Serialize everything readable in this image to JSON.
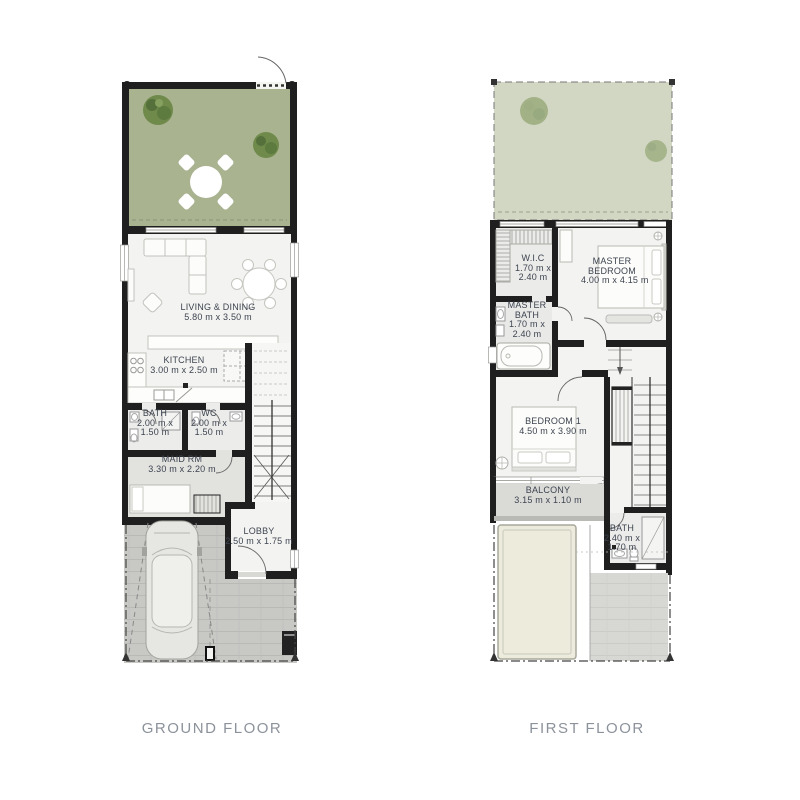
{
  "ground": {
    "title": "GROUND FLOOR",
    "rooms": {
      "living": {
        "name": "LIVING & DINING",
        "dims": "5.80 m x 3.50 m"
      },
      "kitchen": {
        "name": "KITCHEN",
        "dims": "3.00 m x 2.50 m"
      },
      "bath": {
        "name": "BATH",
        "dims": "2.00 m x 1.50 m"
      },
      "wc": {
        "name": "WC",
        "dims": "2.00 m x 1.50 m"
      },
      "maid": {
        "name": "MAID RM",
        "dims": "3.30 m x 2.20 m"
      },
      "lobby": {
        "name": "LOBBY",
        "dims": "2.50 m x 1.75 m"
      }
    }
  },
  "first": {
    "title": "FIRST FLOOR",
    "rooms": {
      "wic": {
        "name": "W.I.C",
        "dims": "1.70 m x 2.40 m"
      },
      "master_bedroom": {
        "name": "MASTER BEDROOM",
        "dims": "4.00 m x 4.15 m"
      },
      "master_bath": {
        "name": "MASTER BATH",
        "dims": "1.70 m x 2.40 m"
      },
      "bedroom1": {
        "name": "BEDROOM 1",
        "dims": "4.50 m x 3.90 m"
      },
      "balcony": {
        "name": "BALCONY",
        "dims": "3.15 m x 1.10 m"
      },
      "bath": {
        "name": "BATH",
        "dims": "2.40 m x 1.70 m"
      }
    }
  },
  "colors": {
    "wall": "#1f1f1f",
    "garden": "#a9b390",
    "garden_faded": "#d2d7c4",
    "tree": "#6f8a4b",
    "floor": "#f3f3f1",
    "floor_gray": "#e4e4e1",
    "tile": "#c8c8c5",
    "label_text": "#3d4450",
    "title_text": "#8c929b",
    "canopy": "#eceadb"
  }
}
